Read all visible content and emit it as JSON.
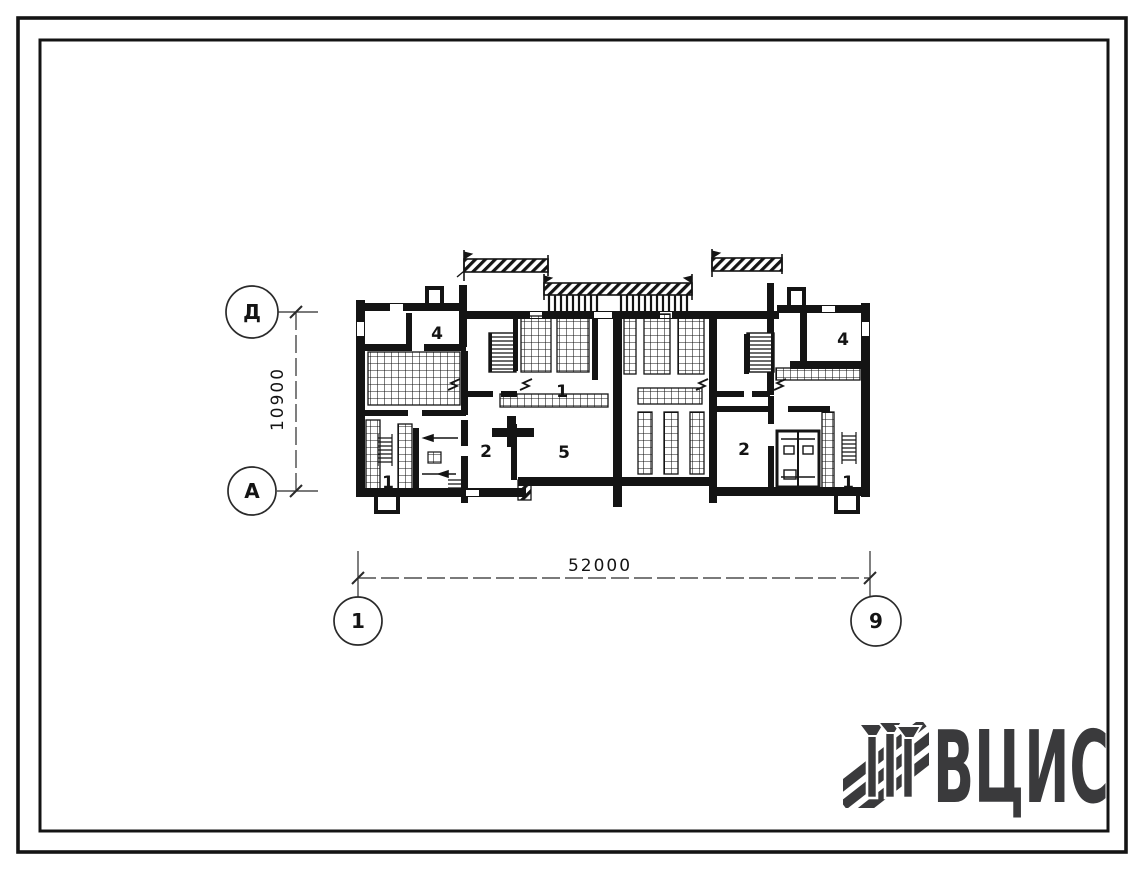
{
  "sheet": {
    "axes": {
      "row_top": "Д",
      "row_bottom": "А",
      "col_left": "1",
      "col_right": "9"
    },
    "dimensions": {
      "overall_width": "52000",
      "overall_depth": "10900"
    },
    "rooms": [
      {
        "label": "4"
      },
      {
        "label": "1"
      },
      {
        "label": "2"
      },
      {
        "label": "5"
      },
      {
        "label": "1"
      },
      {
        "label": "2"
      },
      {
        "label": "4"
      },
      {
        "label": "1"
      }
    ]
  },
  "logo": {
    "text": "ВЦИС",
    "icon": "hatched-columns-logo-icon",
    "color": "#3a3a3c"
  },
  "colors": {
    "ink": "#141414",
    "paper": "#ffffff"
  }
}
